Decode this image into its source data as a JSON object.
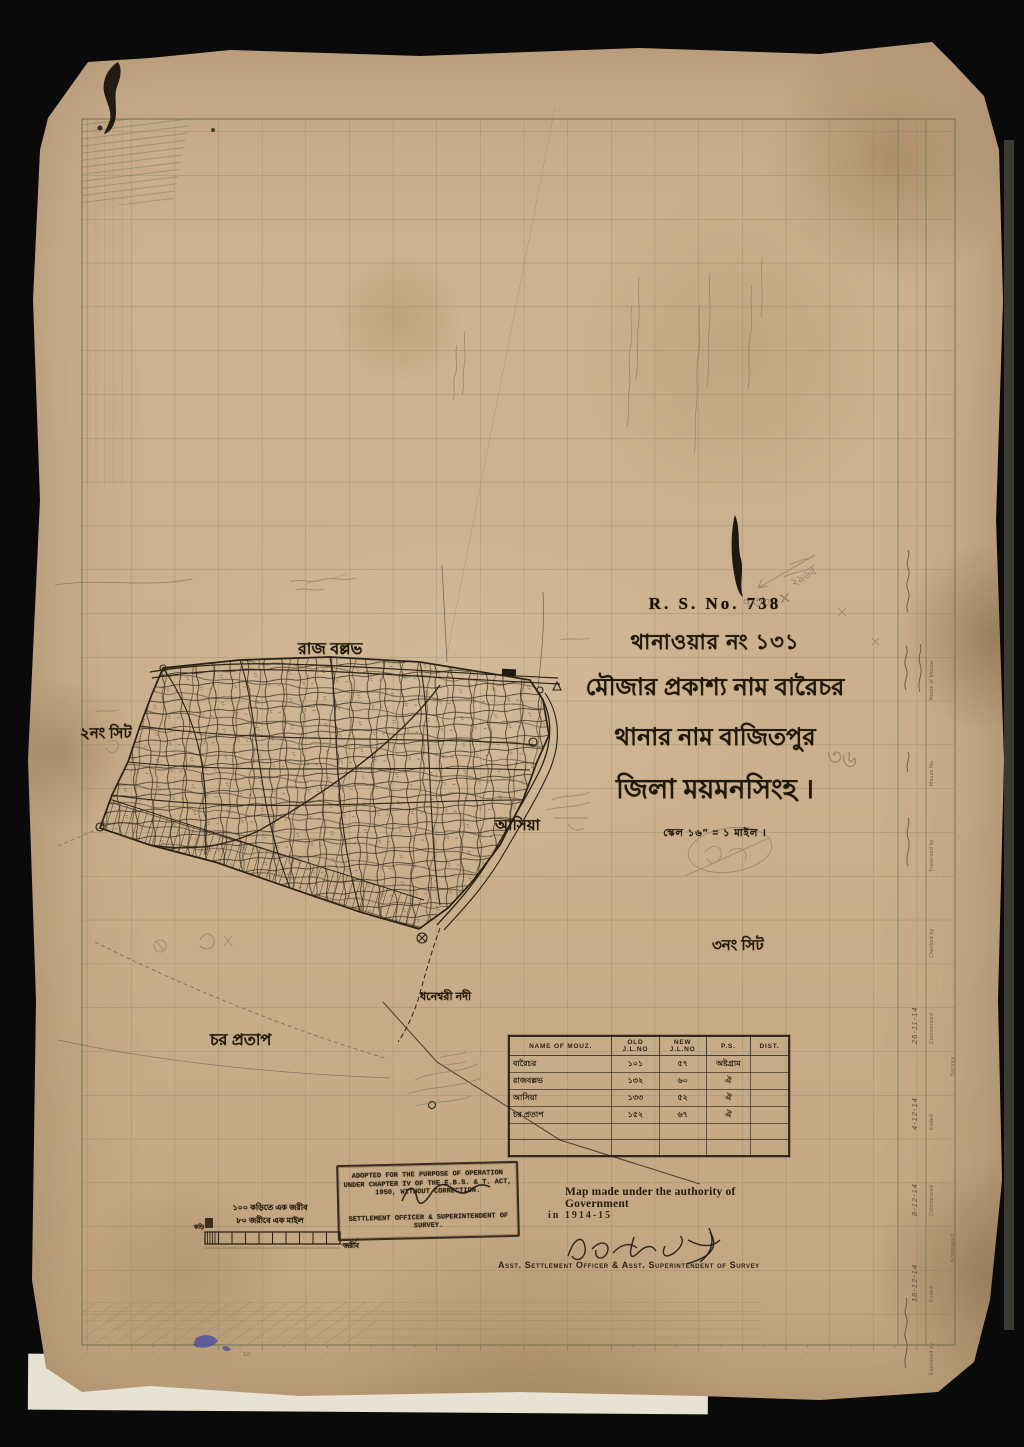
{
  "title_block": {
    "rs_no": "R. S. No. 738",
    "thana_war_no": "থানাওয়ার নং ১৩১",
    "mouza_line": "মৌজার প্রকাশ্য নাম বারৈচর",
    "thana_line": "থানার নাম বাজিতপুর",
    "district_line": "জিলা ময়মনসিংহ ।",
    "scale_line": "স্কেল ১৬″ = ১ মাইল ।"
  },
  "map_labels": {
    "north_mouza": "রাজ বল্লভ",
    "sheet_2": "২নং সিট",
    "east_mouza": "আসিয়া",
    "sheet_3": "৩নং সিট",
    "river": "ধনেশ্বরী নদী",
    "south_mouza": "চর প্রতাপ"
  },
  "pencil_notes": {
    "near_title_no": "৭৩৮ ×",
    "near_title_calc": "২৯৬৫",
    "right_of_scale": "৩৬"
  },
  "mouza_table": {
    "headers": [
      "NAME OF MOUZ.",
      "OLD J.L.NO",
      "NEW J.L.NO",
      "P.S.",
      "DIST."
    ],
    "rows": [
      {
        "name": "বারৈচর",
        "old": "১০১",
        "new": "৫৭",
        "ps": "অষ্টগ্রাম",
        "dist": ""
      },
      {
        "name": "রাজবল্লভ",
        "old": "১৩২",
        "new": "৬০",
        "ps": "ঐ",
        "dist": ""
      },
      {
        "name": "আসিয়া",
        "old": "১৩৩",
        "new": "৫২",
        "ps": "ঐ",
        "dist": ""
      },
      {
        "name": "চর প্রতাপ",
        "old": "১৫২",
        "new": "৬৭",
        "ps": "ঐ",
        "dist": ""
      }
    ]
  },
  "scale_bar": {
    "line1": "১০০ কড়িতে এক জরীব",
    "line2": "৮০ জরীবে এক মাইল",
    "unit_right": "জরীব",
    "unit_left": "কড়ি",
    "ruler_tick_label": "10"
  },
  "stamp": {
    "lines": [
      "ADOPTED FOR THE PURPOSE OF OPERATION",
      "UNDER CHAPTER IV OF THE E.B.S. & T. ACT,",
      "1950, WITHOUT CORRECTION.",
      "SETTLEMENT OFFICER & SUPERINTENDENT OF",
      "SURVEY."
    ]
  },
  "authority": {
    "line1": "Map made under the authority of Government",
    "line2": "in 1914-15",
    "officer": "Asst. Settlement Officer & Asst. Superintendent of Survey"
  },
  "margin_form": {
    "rows": [
      {
        "label": "Name of Mouza",
        "entry": ""
      },
      {
        "label": "Mouza No.",
        "entry": ""
      },
      {
        "label": "Traversed by",
        "entry": ""
      },
      {
        "label": "Checked by",
        "entry": ""
      },
      {
        "label": "Commenced",
        "entry": "26-11-14"
      },
      {
        "label": "Ended",
        "entry": "4-12-14"
      },
      {
        "label": "Commenced",
        "entry": "8-12-14"
      },
      {
        "label": "Ended",
        "entry": "18-12-14"
      },
      {
        "label": "Examined by",
        "entry": ""
      }
    ],
    "groups": [
      "Survey",
      "Khanapuri"
    ]
  },
  "colors": {
    "paper": "#c9ad8a",
    "grid": "#7c8560",
    "ink": "#241b0c",
    "pencil": "#857a66",
    "blue_blot": "#4a4e9e"
  }
}
